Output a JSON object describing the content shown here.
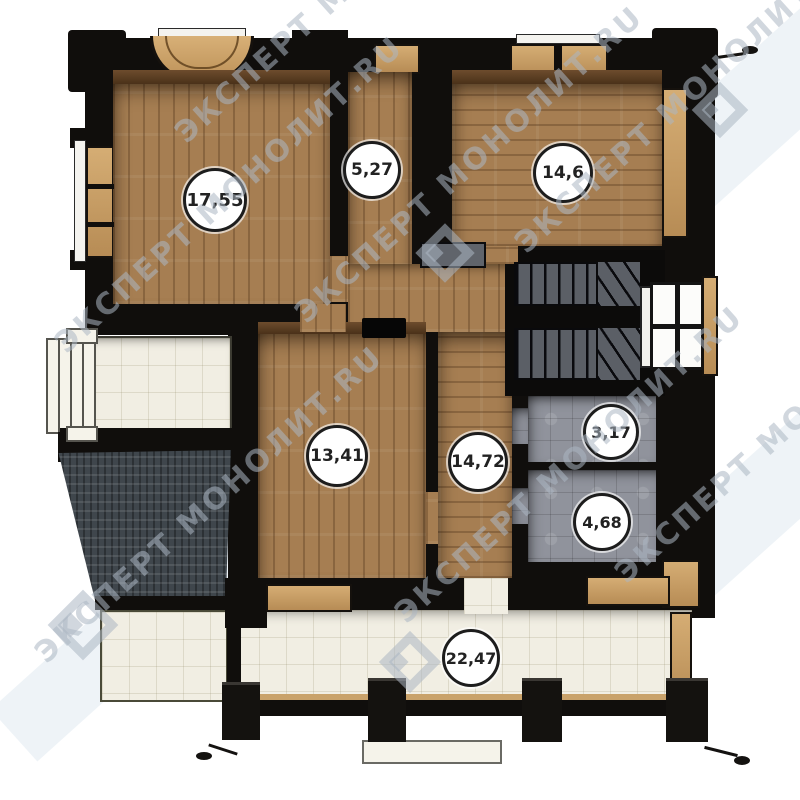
{
  "plan": {
    "rooms": [
      {
        "name": "room-17-55",
        "label": "17,55"
      },
      {
        "name": "hallway-5-27",
        "label": "5,27"
      },
      {
        "name": "room-14-6",
        "label": "14,6"
      },
      {
        "name": "room-13-41",
        "label": "13,41"
      },
      {
        "name": "hall-14-72",
        "label": "14,72"
      },
      {
        "name": "wc-3-17",
        "label": "3,17"
      },
      {
        "name": "bathroom-4-68",
        "label": "4,68"
      },
      {
        "name": "terrace-22-47",
        "label": "22,47"
      }
    ],
    "watermark": {
      "text": "ЭКСПЕРТ МОНОЛИТ.RU",
      "logo": "monolit-diamond-logo"
    },
    "colors": {
      "wall": "#100e0c",
      "wood_floor": "#a67e52",
      "wood_trim": "#c9a26a",
      "gray_tile": "#90939c",
      "stair_tread": "#5b5f66",
      "terrace_tile": "#f1eee3",
      "roof_shingle": "#3f464c",
      "badge_bg": "#ffffff",
      "badge_border": "#1d1d1d",
      "watermark": "#acb7c3"
    }
  }
}
